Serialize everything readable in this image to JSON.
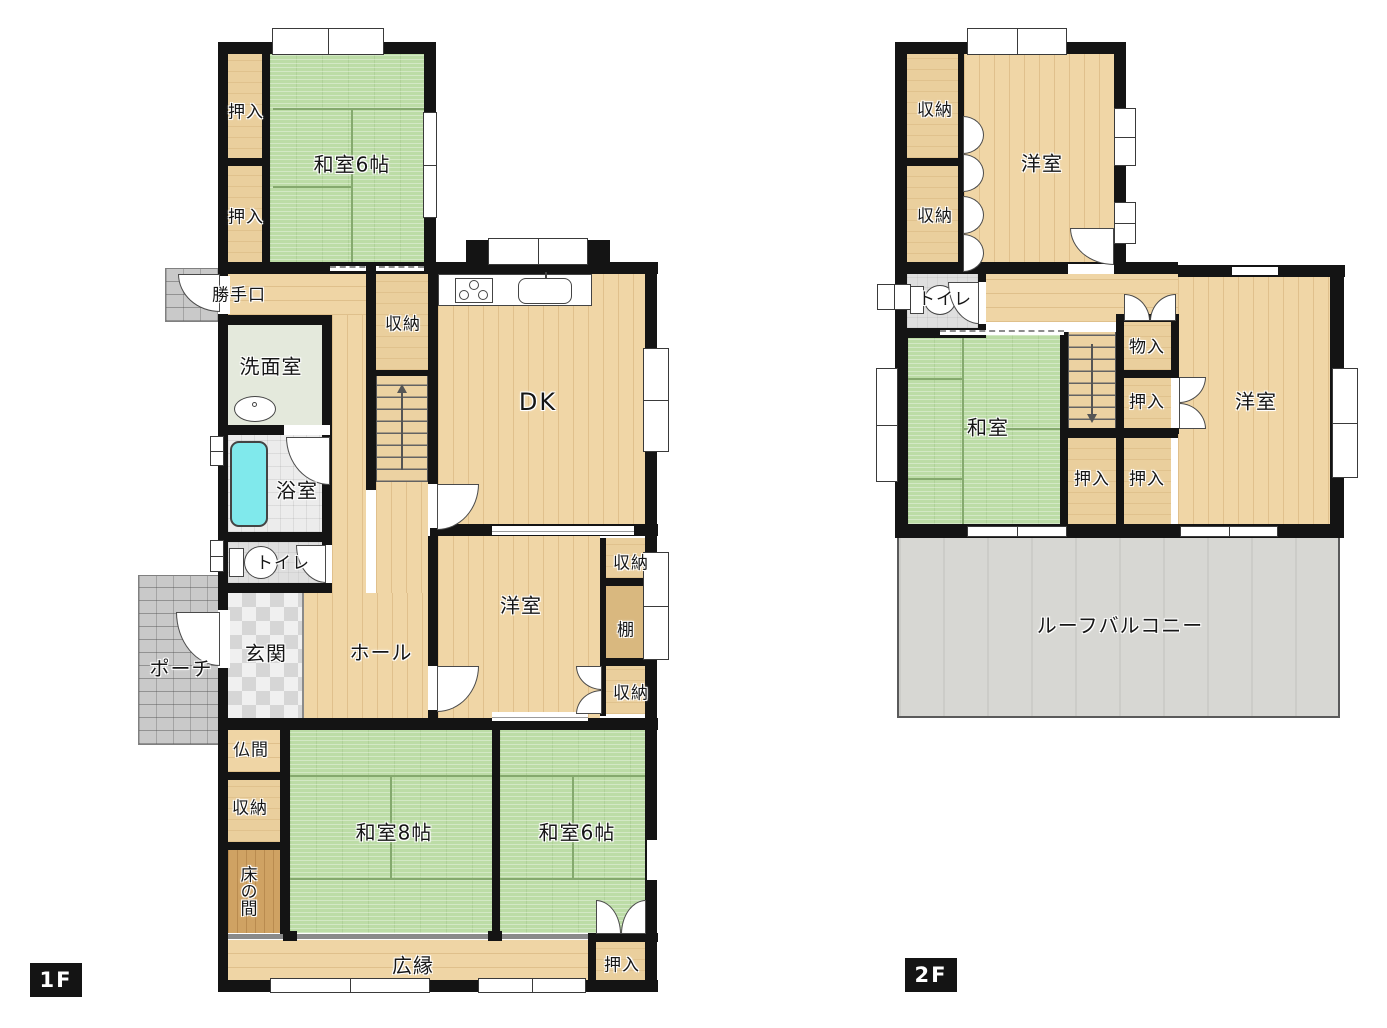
{
  "floor1": {
    "tag": "1F",
    "labels": {
      "oshiire_top1": "押入",
      "oshiire_top2": "押入",
      "washitsu6_top": "和室6帖",
      "katteguchi": "勝手口",
      "shuno_kitchen": "収納",
      "senmenshitsu": "洗面室",
      "dk": "DK",
      "yokushitsu": "浴室",
      "toire": "トイレ",
      "genkan": "玄関",
      "hooru": "ホール",
      "yoshitsu": "洋室",
      "shuno_r_top": "収納",
      "tana": "棚",
      "shuno_r_btm": "収納",
      "poochi": "ポーチ",
      "butsuma": "仏間",
      "shuno_l": "収納",
      "tokonoma": "床の間",
      "washitsu8": "和室8帖",
      "washitsu6": "和室6帖",
      "hiroen": "広縁",
      "oshiire_btm": "押入"
    }
  },
  "floor2": {
    "tag": "2F",
    "labels": {
      "shuno1": "収納",
      "shuno2": "収納",
      "yoshitsu_top": "洋室",
      "toire": "トイレ",
      "mononyu": "物入",
      "oshiire_mid": "押入",
      "washitsu": "和室",
      "oshiire_b1": "押入",
      "oshiire_b2": "押入",
      "yoshitsu_right": "洋室",
      "roof_balcony": "ルーフバルコニー"
    }
  },
  "colors": {
    "wall": "#141414",
    "tatami_green": "#bcdca6",
    "wood_floor": "#f0d6a6",
    "closet_wood": "#eacf9d",
    "tokonoma_wood": "#cfa263",
    "shelf_wood": "#d9b87f",
    "balcony_gray": "#d7d7d3",
    "bathtub_cyan": "#80e9ec",
    "label_tag_bg": "#141414",
    "label_tag_text": "#ffffff"
  }
}
